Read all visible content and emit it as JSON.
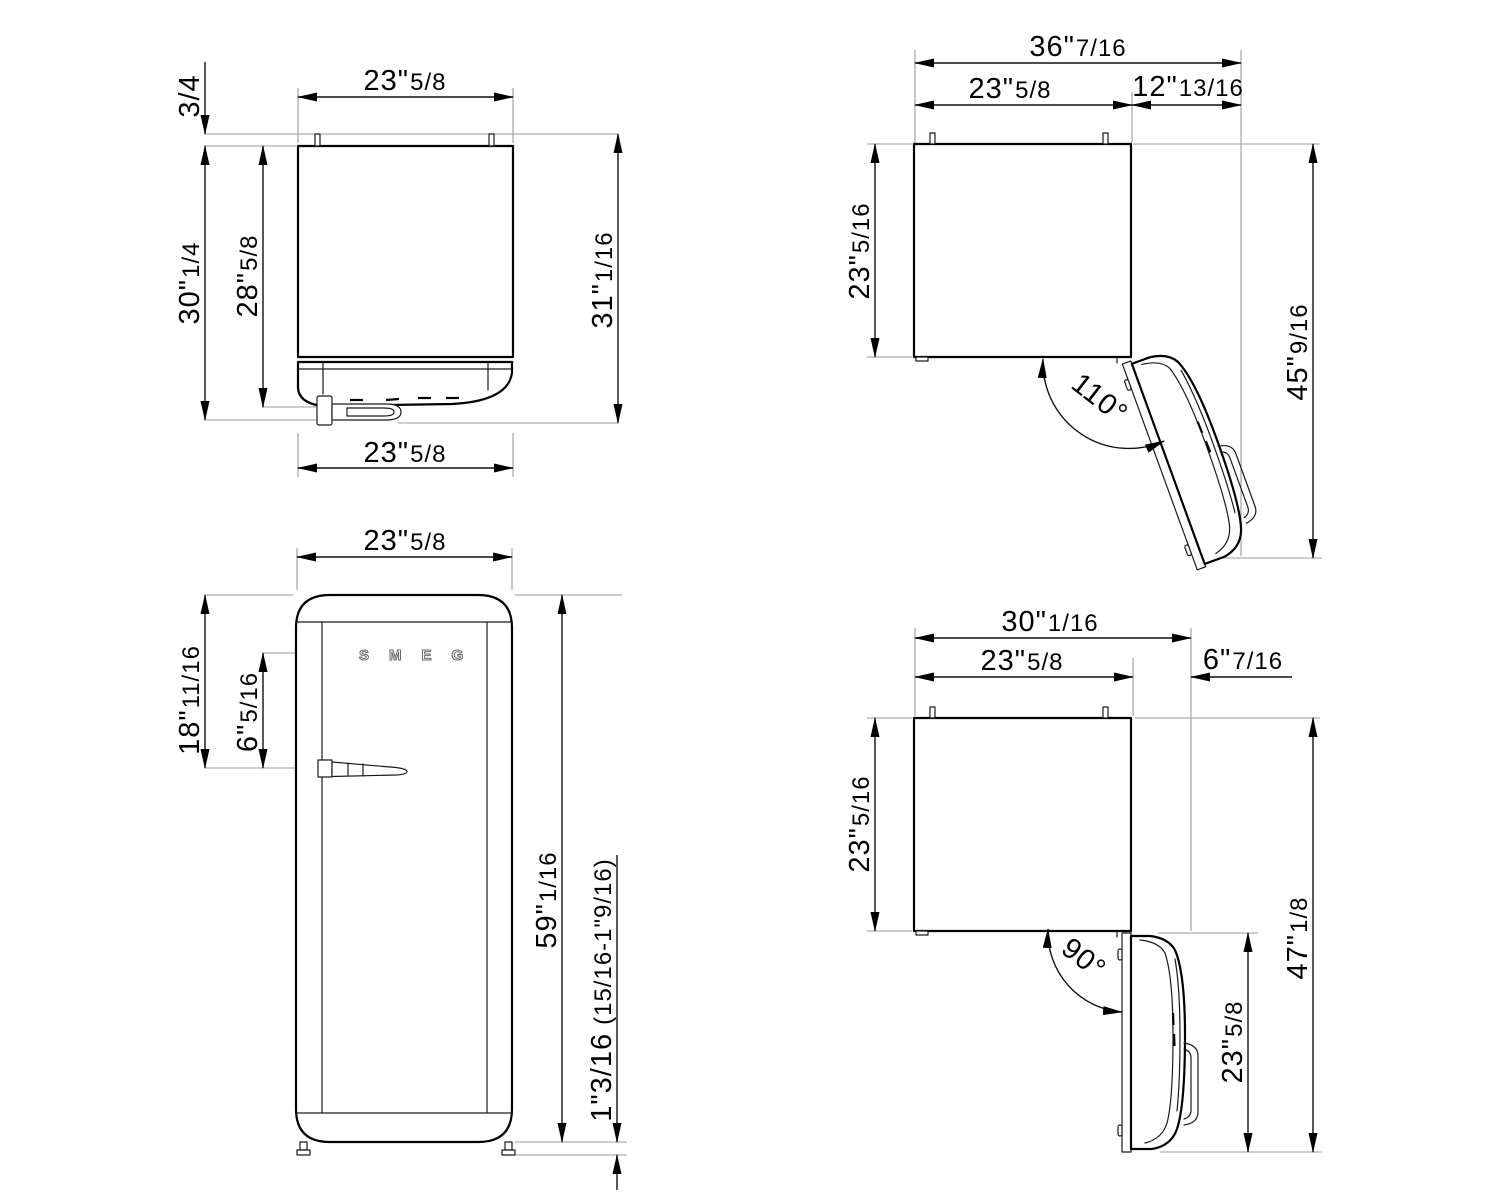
{
  "drawing_type": "refrigerator installation dimension drawing",
  "colors": {
    "line": "#000000",
    "dimension": "#111111",
    "extension": "#9a9a9a",
    "background": "#ffffff"
  },
  "views": {
    "top_view": {
      "description": "plan view, door closed",
      "dims": {
        "top_width": {
          "m": "23\"",
          "f": "5/8"
        },
        "pin_height": {
          "m": "3/4",
          "f": ""
        },
        "depth_total": {
          "m": "30\"",
          "f": "1/4"
        },
        "depth_body": {
          "m": "28\"",
          "f": "5/8"
        },
        "depth_overall": {
          "m": "31\"",
          "f": "1/16"
        },
        "bottom_width": {
          "m": "23\"",
          "f": "5/8"
        }
      }
    },
    "open110_view": {
      "description": "plan view, door open 110 degrees",
      "dims": {
        "total_width": {
          "m": "36\"",
          "f": "7/16"
        },
        "body_width": {
          "m": "23\"",
          "f": "5/8"
        },
        "door_projection": {
          "m": "12\"",
          "f": "13/16"
        },
        "body_depth": {
          "m": "23\"",
          "f": "5/16"
        },
        "open_depth": {
          "m": "45\"",
          "f": "9/16"
        },
        "door_angle": "110°"
      }
    },
    "front_view": {
      "description": "front elevation",
      "logo": "SMEG",
      "dims": {
        "width": {
          "m": "23\"",
          "f": "5/8"
        },
        "top_to_handle": {
          "m": "18\"",
          "f": "11/16"
        },
        "logo_to_handle": {
          "m": "6\"",
          "f": "5/16"
        },
        "height": {
          "m": "59\"",
          "f": "1/16"
        },
        "feet": {
          "m": "1\"3/16",
          "f": "(15/16-1\"9/16)"
        }
      }
    },
    "open90_view": {
      "description": "plan view, door open 90 degrees",
      "dims": {
        "total_depth": {
          "m": "30\"",
          "f": "1/16"
        },
        "body_width_horiz": {
          "m": "23\"",
          "f": "5/8"
        },
        "door_projection": {
          "m": "6\"",
          "f": "7/16"
        },
        "body_depth": {
          "m": "23\"",
          "f": "5/16"
        },
        "door_length": {
          "m": "23\"",
          "f": "5/8"
        },
        "open_depth": {
          "m": "47\"",
          "f": "1/8"
        },
        "door_angle": "90°"
      }
    }
  }
}
